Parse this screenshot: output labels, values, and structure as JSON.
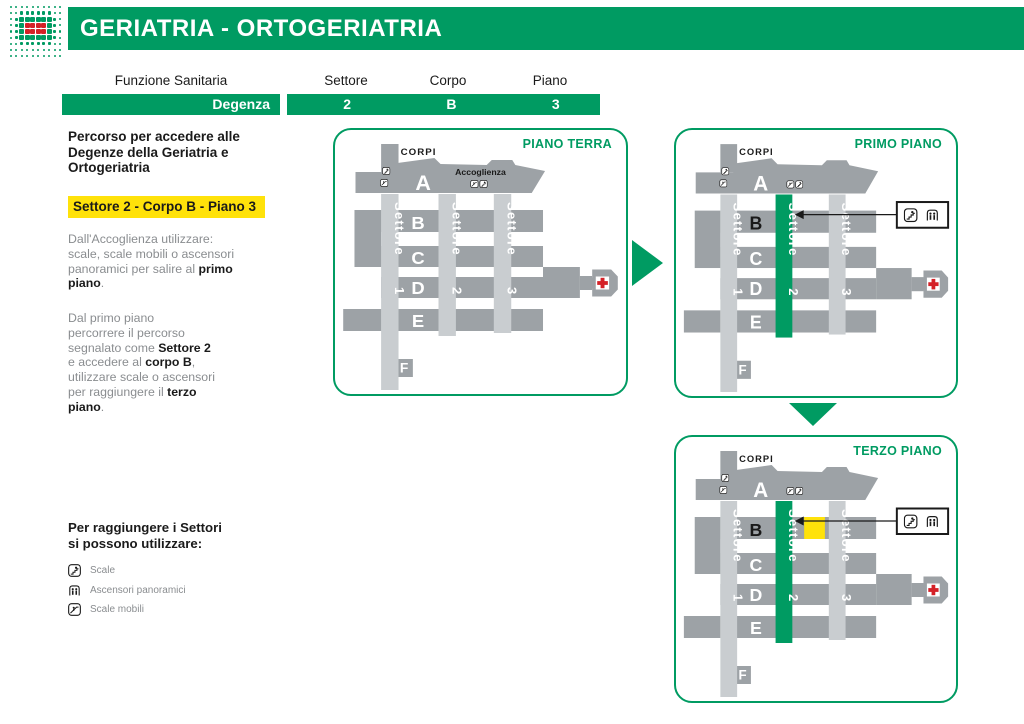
{
  "theme": {
    "green": "#009B62",
    "yellow": "#FFE20A",
    "building_gray": "#9DA2A6",
    "band_gray": "#C9CDD0",
    "text_gray": "#8A8D90",
    "ink": "#1A1A1A",
    "red": "#D42127"
  },
  "header": {
    "title": "GERIATRIA - ORTOGERIATRIA",
    "logo_rows": [
      "ssssssssss",
      "ssmmmmmmss",
      "smllllllms",
      "smlRRRRlms",
      "smlRRRRlms",
      "smllllllms",
      "ssmmmmmmss",
      "ssssssssss",
      "ssssssssss"
    ]
  },
  "info_table": {
    "function_label": "Funzione Sanitaria",
    "function_value": "Degenza",
    "columns": [
      {
        "label": "Settore",
        "value": "2"
      },
      {
        "label": "Corpo",
        "value": "B"
      },
      {
        "label": "Piano",
        "value": "3"
      }
    ]
  },
  "sidebar": {
    "intro_lines": [
      "Percorso per accedere alle",
      "Degenze della Geriatria e",
      "Ortogeriatria"
    ],
    "highlight": "Settore 2 - Corpo B - Piano 3",
    "paragraphs": [
      {
        "lines": [
          [
            {
              "t": "Dall'Accoglienza utilizzare:"
            }
          ],
          [
            {
              "t": "scale, scale mobili o ascensori"
            }
          ],
          [
            {
              "t": "panoramici per salire al "
            },
            {
              "t": "primo",
              "b": true
            }
          ],
          [
            {
              "t": "piano",
              "b": true
            },
            {
              "t": "."
            }
          ]
        ]
      },
      {
        "lines": [
          [
            {
              "t": "Dal primo piano"
            }
          ],
          [
            {
              "t": "percorrere il percorso"
            }
          ],
          [
            {
              "t": "segnalato come "
            },
            {
              "t": "Settore 2",
              "b": true
            }
          ],
          [
            {
              "t": "e accedere al "
            },
            {
              "t": "corpo B",
              "b": true
            },
            {
              "t": ","
            }
          ],
          [
            {
              "t": "utilizzare scale o ascensori"
            }
          ],
          [
            {
              "t": "per raggiungere il "
            },
            {
              "t": "terzo",
              "b": true
            }
          ],
          [
            {
              "t": "piano",
              "b": true
            },
            {
              "t": "."
            }
          ]
        ]
      }
    ],
    "legend_title_lines": [
      "Per raggiungere i Settori",
      "si possono utilizzare:"
    ],
    "legend_items": [
      {
        "icon": "stairs-icon",
        "label": "Scale"
      },
      {
        "icon": "elevator-icon",
        "label": "Ascensori panoramici"
      },
      {
        "icon": "escalator-icon",
        "label": "Scale mobili"
      }
    ]
  },
  "panels": [
    {
      "title": "PIANO TERRA",
      "accoglienza": "Accoglienza",
      "sector2_active": false,
      "b_dark": false,
      "yellow_room": false,
      "callout": false
    },
    {
      "title": "PRIMO PIANO",
      "accoglienza": "",
      "sector2_active": true,
      "b_dark": true,
      "yellow_room": false,
      "callout": true
    },
    {
      "title": "TERZO PIANO",
      "accoglienza": "",
      "sector2_active": true,
      "b_dark": true,
      "yellow_room": true,
      "callout": true
    }
  ],
  "map_labels": {
    "corpi": "CORPI",
    "corpo_a": "A",
    "rows": [
      "B",
      "C",
      "D",
      "E"
    ],
    "f": "F",
    "sectors": [
      "Settore 1",
      "Settore 2",
      "Settore 3"
    ]
  }
}
